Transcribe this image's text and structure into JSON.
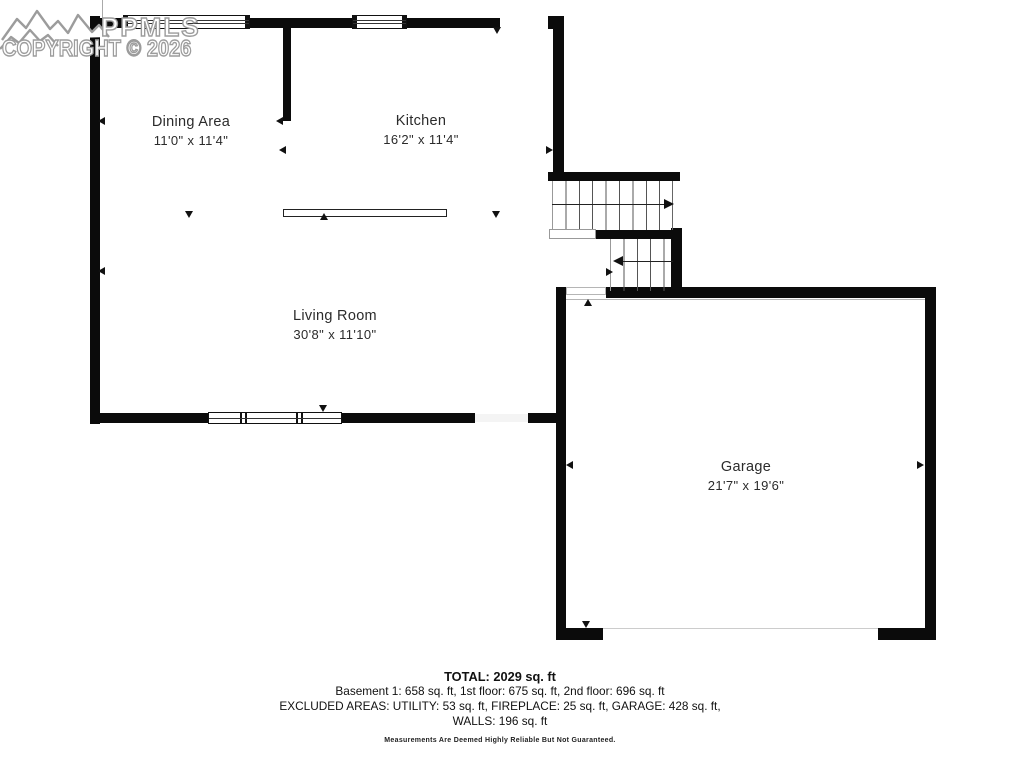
{
  "watermark": {
    "logo": "mountains-icon",
    "brand": "PPMLS",
    "copyright": "COPYRIGHT © 2026"
  },
  "rooms": [
    {
      "id": "dining",
      "name": "Dining Area",
      "dimensions": "11'0\" x 11'4\""
    },
    {
      "id": "kitchen",
      "name": "Kitchen",
      "dimensions": "16'2\" x 11'4\""
    },
    {
      "id": "living",
      "name": "Living Room",
      "dimensions": "30'8\" x 11'10\""
    },
    {
      "id": "garage",
      "name": "Garage",
      "dimensions": "21'7\" x 19'6\""
    }
  ],
  "summary": {
    "total": "TOTAL: 2029 sq. ft",
    "floors": "Basement 1: 658 sq. ft, 1st floor: 675 sq. ft, 2nd floor: 696 sq. ft",
    "excluded": "EXCLUDED AREAS: UTILITY: 53 sq. ft, FIREPLACE: 25 sq. ft, GARAGE: 428 sq. ft,",
    "walls": "WALLS: 196 sq. ft",
    "disclaimer": "Measurements Are Deemed Highly Reliable But Not Guaranteed."
  },
  "colors": {
    "wall": "#0b0b0b",
    "tread_line": "#555555",
    "watermark_outline": "#9c9c9c",
    "label_text": "#2b2b2b"
  }
}
